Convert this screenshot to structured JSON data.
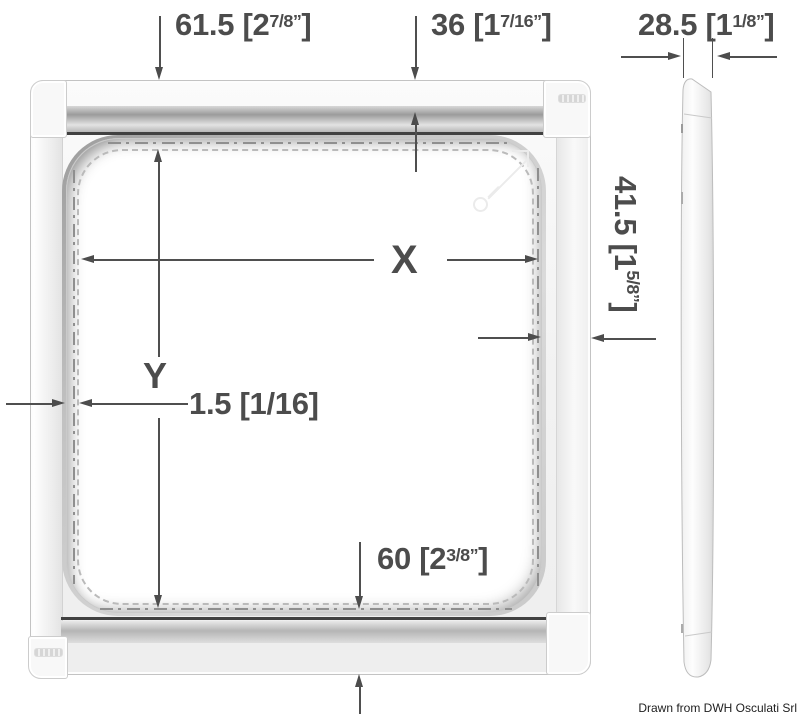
{
  "drawing": {
    "credit": "Drawn from DWH Osculati Srl",
    "dimensions": {
      "top_left_offset": {
        "main": "61.5 [2",
        "sup": "7/8”",
        "end": "]"
      },
      "top_rail": {
        "main": "36 [1",
        "sup": "7/16”",
        "end": "]"
      },
      "side_thickness": {
        "main": "28.5 [1",
        "sup": "1/8”",
        "end": "]"
      },
      "right_border": {
        "main": "41.5 [1",
        "sup": "5/8”",
        "end": "]"
      },
      "width_label": "X",
      "height_label": "Y",
      "flange_gap": {
        "main": "1.5 [1/16]",
        "sup": "",
        "end": ""
      },
      "bottom_border": {
        "main": "60 [2",
        "sup": "3/8”",
        "end": "]"
      }
    },
    "colors": {
      "dimension_text": "#4c4c4c",
      "frame_dark_line": "#414141",
      "centerline": "#8f8f8f",
      "frame_fill": "#f2f2f2"
    }
  }
}
